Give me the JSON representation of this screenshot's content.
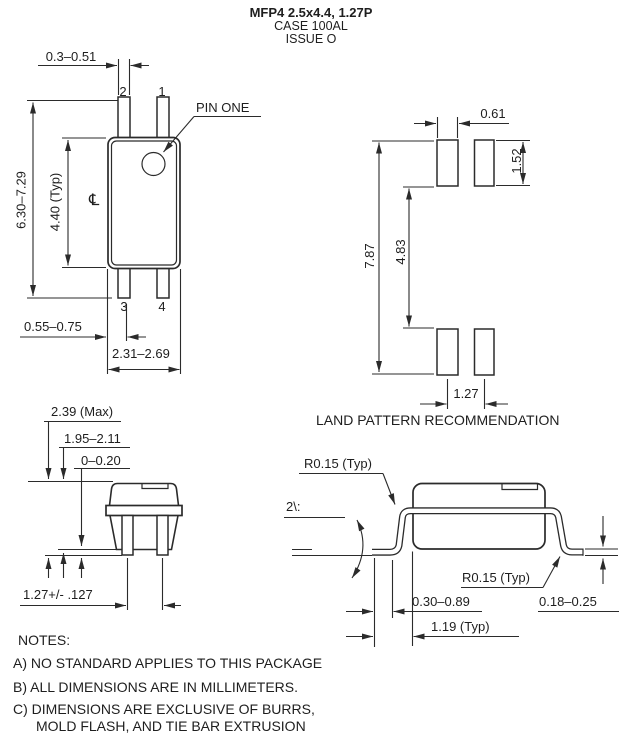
{
  "header": {
    "title": "MFP4 2.5x4.4, 1.27P",
    "case": "CASE 100AL",
    "issue": "ISSUE O"
  },
  "top_view": {
    "pin_width": "0.3–0.51",
    "pin1": "1",
    "pin2": "2",
    "pin3": "3",
    "pin4": "4",
    "pin_one_callout": "PIN ONE",
    "overall_length": "6.30–7.29",
    "body_length": "4.40 (Typ)",
    "centerline_symbol": "℄",
    "pin_edge_offset": "0.55–0.75",
    "body_width": "2.31–2.69"
  },
  "land_pattern": {
    "pad_width": "0.61",
    "pad_height": "1.52",
    "overall_span": "7.87",
    "inner_span": "4.83",
    "pad_pitch": "1.27",
    "caption": "LAND PATTERN RECOMMENDATION"
  },
  "end_view": {
    "max_height": "2.39 (Max)",
    "body_height": "1.95–2.11",
    "standoff": "0–0.20",
    "lead_pitch": "1.27+/- .127"
  },
  "side_view": {
    "radius_top": "R0.15 (Typ)",
    "radius_bottom": "R0.15 (Typ)",
    "lead_angle": "2\\:",
    "foot_length": "0.30–0.89",
    "lead_length": "1.19 (Typ)",
    "lead_thickness": "0.18–0.25"
  },
  "notes": {
    "heading": "NOTES:",
    "items": [
      "A) NO STANDARD APPLIES TO THIS PACKAGE",
      "B) ALL DIMENSIONS ARE IN MILLIMETERS.",
      "C) DIMENSIONS ARE EXCLUSIVE OF BURRS,",
      "MOLD FLASH, AND TIE BAR EXTRUSION"
    ]
  }
}
